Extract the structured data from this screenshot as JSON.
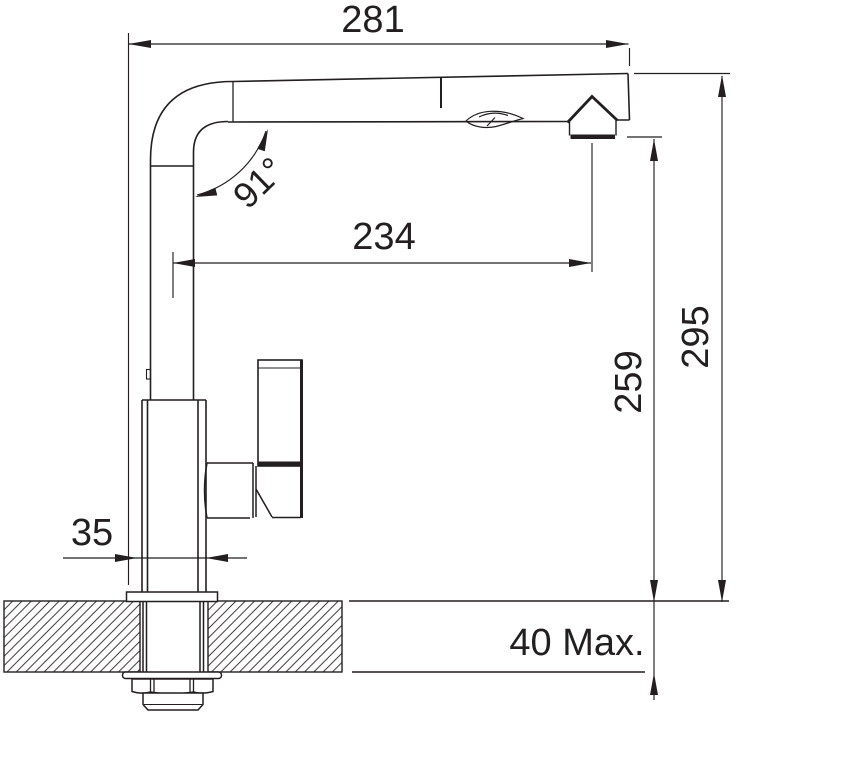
{
  "drawing": {
    "type": "technical-dimension-drawing",
    "subject": "pull-out kitchen mixer tap, side view with countertop cross-section",
    "line_color": "#231f20",
    "background_color": "#ffffff",
    "units_shown": "mm (implied, unlabeled)",
    "dimensions": {
      "total_width": {
        "label": "281",
        "orientation": "horizontal",
        "measures": "overall horizontal reach at top"
      },
      "spout_reach": {
        "label": "234",
        "orientation": "horizontal",
        "measures": "axis of riser to axis of spray outlet"
      },
      "spout_angle": {
        "label": "91°",
        "orientation": "angular",
        "measures": "angle between riser and spout arm"
      },
      "outlet_height": {
        "label": "259",
        "orientation": "vertical",
        "measures": "countertop to spray outlet"
      },
      "total_height": {
        "label": "295",
        "orientation": "vertical",
        "measures": "countertop to top of spout"
      },
      "base_width": {
        "label": "35",
        "orientation": "horizontal",
        "measures": "base / mounting hole diameter"
      },
      "counter_thickness": {
        "label": "40 Max.",
        "orientation": "vertical",
        "measures": "maximum countertop thickness"
      }
    }
  }
}
